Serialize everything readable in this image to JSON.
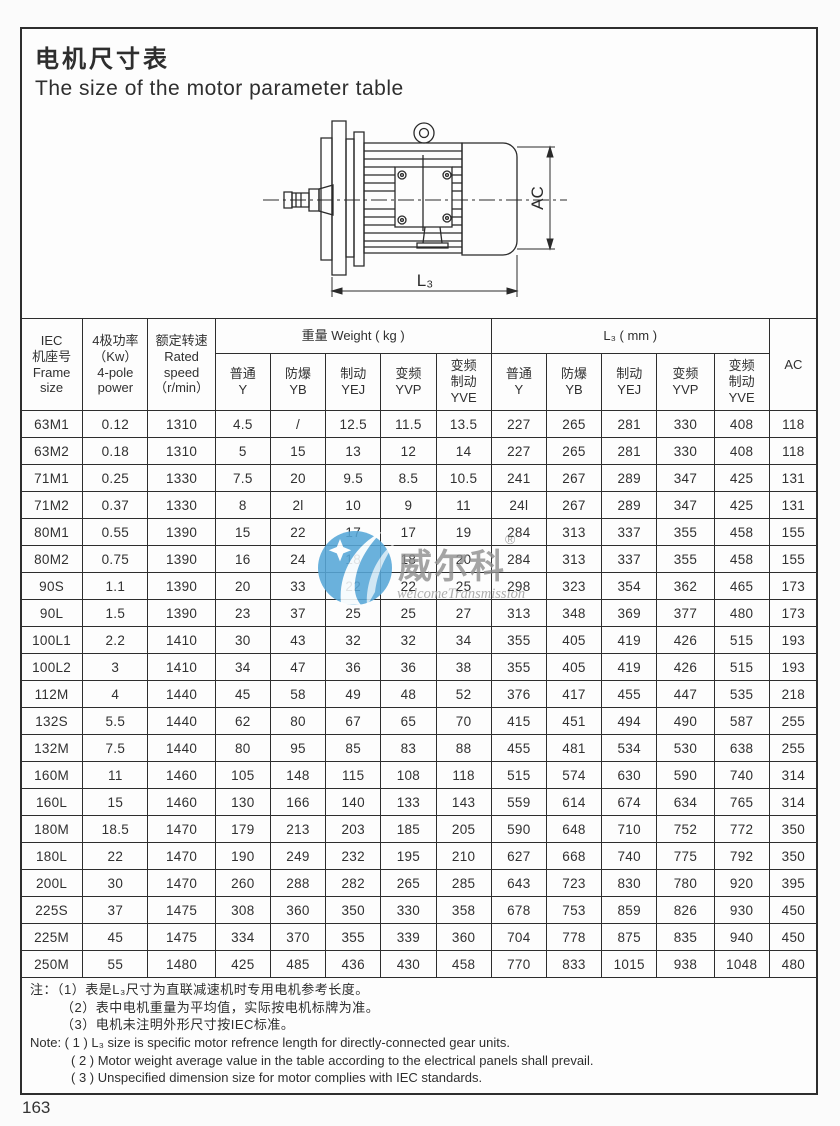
{
  "page": {
    "title_cn": "电机尺寸表",
    "title_en": "The size of the motor parameter table",
    "page_number": "163"
  },
  "drawing": {
    "dim_height_label": "AC",
    "dim_length_label": "L₃"
  },
  "watermark": {
    "brand": "威尔科",
    "registered": "®",
    "subtitle": "welcomeTransmission",
    "circle_color": "#56a7d8",
    "text_color": "#8f8f8f"
  },
  "table": {
    "group_headers": {
      "frame": "IEC\n机座号\nFrame\nsize",
      "power": "4极功率\n（Kw）\n4-pole\npower",
      "speed": "额定转速\nRated\nspeed\n（r/min）",
      "weight": "重量 Weight ( kg )",
      "l3": "L₃ ( mm )",
      "ac": "AC"
    },
    "sub_headers": [
      "普通\nY",
      "防爆\nYB",
      "制动\nYEJ",
      "变频\nYVP",
      "变频\n制动\nYVE"
    ],
    "rows": [
      [
        "63M1",
        "0.12",
        "1310",
        "4.5",
        "/",
        "12.5",
        "11.5",
        "13.5",
        "227",
        "265",
        "281",
        "330",
        "408",
        "118"
      ],
      [
        "63M2",
        "0.18",
        "1310",
        "5",
        "15",
        "13",
        "12",
        "14",
        "227",
        "265",
        "281",
        "330",
        "408",
        "118"
      ],
      [
        "71M1",
        "0.25",
        "1330",
        "7.5",
        "20",
        "9.5",
        "8.5",
        "10.5",
        "241",
        "267",
        "289",
        "347",
        "425",
        "131"
      ],
      [
        "71M2",
        "0.37",
        "1330",
        "8",
        "2l",
        "10",
        "9",
        "11",
        "24l",
        "267",
        "289",
        "347",
        "425",
        "131"
      ],
      [
        "80M1",
        "0.55",
        "1390",
        "15",
        "22",
        "17",
        "17",
        "19",
        "284",
        "313",
        "337",
        "355",
        "458",
        "155"
      ],
      [
        "80M2",
        "0.75",
        "1390",
        "16",
        "24",
        "18",
        "18",
        "20",
        "284",
        "313",
        "337",
        "355",
        "458",
        "155"
      ],
      [
        "90S",
        "1.1",
        "1390",
        "20",
        "33",
        "22",
        "22",
        "25",
        "298",
        "323",
        "354",
        "362",
        "465",
        "173"
      ],
      [
        "90L",
        "1.5",
        "1390",
        "23",
        "37",
        "25",
        "25",
        "27",
        "313",
        "348",
        "369",
        "377",
        "480",
        "173"
      ],
      [
        "100L1",
        "2.2",
        "1410",
        "30",
        "43",
        "32",
        "32",
        "34",
        "355",
        "405",
        "419",
        "426",
        "515",
        "193"
      ],
      [
        "100L2",
        "3",
        "1410",
        "34",
        "47",
        "36",
        "36",
        "38",
        "355",
        "405",
        "419",
        "426",
        "515",
        "193"
      ],
      [
        "112M",
        "4",
        "1440",
        "45",
        "58",
        "49",
        "48",
        "52",
        "376",
        "417",
        "455",
        "447",
        "535",
        "218"
      ],
      [
        "132S",
        "5.5",
        "1440",
        "62",
        "80",
        "67",
        "65",
        "70",
        "415",
        "451",
        "494",
        "490",
        "587",
        "255"
      ],
      [
        "132M",
        "7.5",
        "1440",
        "80",
        "95",
        "85",
        "83",
        "88",
        "455",
        "481",
        "534",
        "530",
        "638",
        "255"
      ],
      [
        "160M",
        "11",
        "1460",
        "105",
        "148",
        "115",
        "108",
        "118",
        "515",
        "574",
        "630",
        "590",
        "740",
        "314"
      ],
      [
        "160L",
        "15",
        "1460",
        "130",
        "166",
        "140",
        "133",
        "143",
        "559",
        "614",
        "674",
        "634",
        "765",
        "314"
      ],
      [
        "180M",
        "18.5",
        "1470",
        "179",
        "213",
        "203",
        "185",
        "205",
        "590",
        "648",
        "710",
        "752",
        "772",
        "350"
      ],
      [
        "180L",
        "22",
        "1470",
        "190",
        "249",
        "232",
        "195",
        "210",
        "627",
        "668",
        "740",
        "775",
        "792",
        "350"
      ],
      [
        "200L",
        "30",
        "1470",
        "260",
        "288",
        "282",
        "265",
        "285",
        "643",
        "723",
        "830",
        "780",
        "920",
        "395"
      ],
      [
        "225S",
        "37",
        "1475",
        "308",
        "360",
        "350",
        "330",
        "358",
        "678",
        "753",
        "859",
        "826",
        "930",
        "450"
      ],
      [
        "225M",
        "45",
        "1475",
        "334",
        "370",
        "355",
        "339",
        "360",
        "704",
        "778",
        "875",
        "835",
        "940",
        "450"
      ],
      [
        "250M",
        "55",
        "1480",
        "425",
        "485",
        "436",
        "430",
        "458",
        "770",
        "833",
        "1015",
        "938",
        "1048",
        "480"
      ]
    ]
  },
  "notes": {
    "cn": [
      "注：（1）表是L₃尺寸为直联减速机时专用电机参考长度。",
      "（2）表中电机重量为平均值，实际按电机标牌为准。",
      "（3）电机未注明外形尺寸按IEC标准。"
    ],
    "en": [
      "Note: ( 1 ) L₃ size is specific motor refrence length for directly-connected gear units.",
      "( 2 ) Motor weight average value in the table according to the electrical panels shall prevail.",
      "( 3 ) Unspecified dimension size for motor complies with IEC standards."
    ]
  }
}
